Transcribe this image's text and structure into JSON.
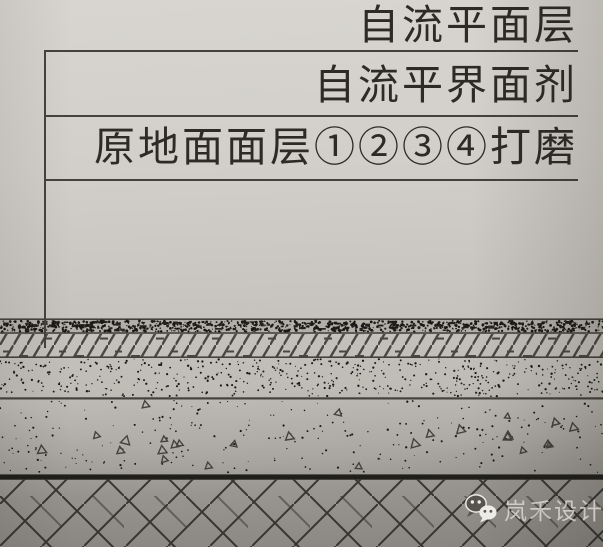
{
  "callouts": {
    "layer1": "自流平面层",
    "layer2": "自流平界面剂",
    "layer3": "原地面面层①②③④打磨"
  },
  "watermark": {
    "brand": "岚禾设计",
    "icon": "wechat-icon"
  },
  "layers": [
    {
      "label": "自流平面层",
      "pattern": "dense-stipple-band"
    },
    {
      "label": "自流平界面剂",
      "pattern": "diagonal-hatch-band"
    },
    {
      "label": "原地面面层①②③④打磨",
      "pattern": "fine-stipple-band"
    },
    {
      "label": "",
      "pattern": "concrete-aggregate-band"
    },
    {
      "label": "",
      "pattern": "diagonal-brick-slab"
    }
  ],
  "colors": {
    "paper_top": "#d8d5d0",
    "paper_mid": "#c7c4bf",
    "paper_bottom": "#94918c",
    "ink": "#45423e",
    "ink_text": "#2e2b27",
    "ink_heavy": "#211f1b",
    "stipple": "#1b1916",
    "watermark_text": "#dedbd6"
  }
}
